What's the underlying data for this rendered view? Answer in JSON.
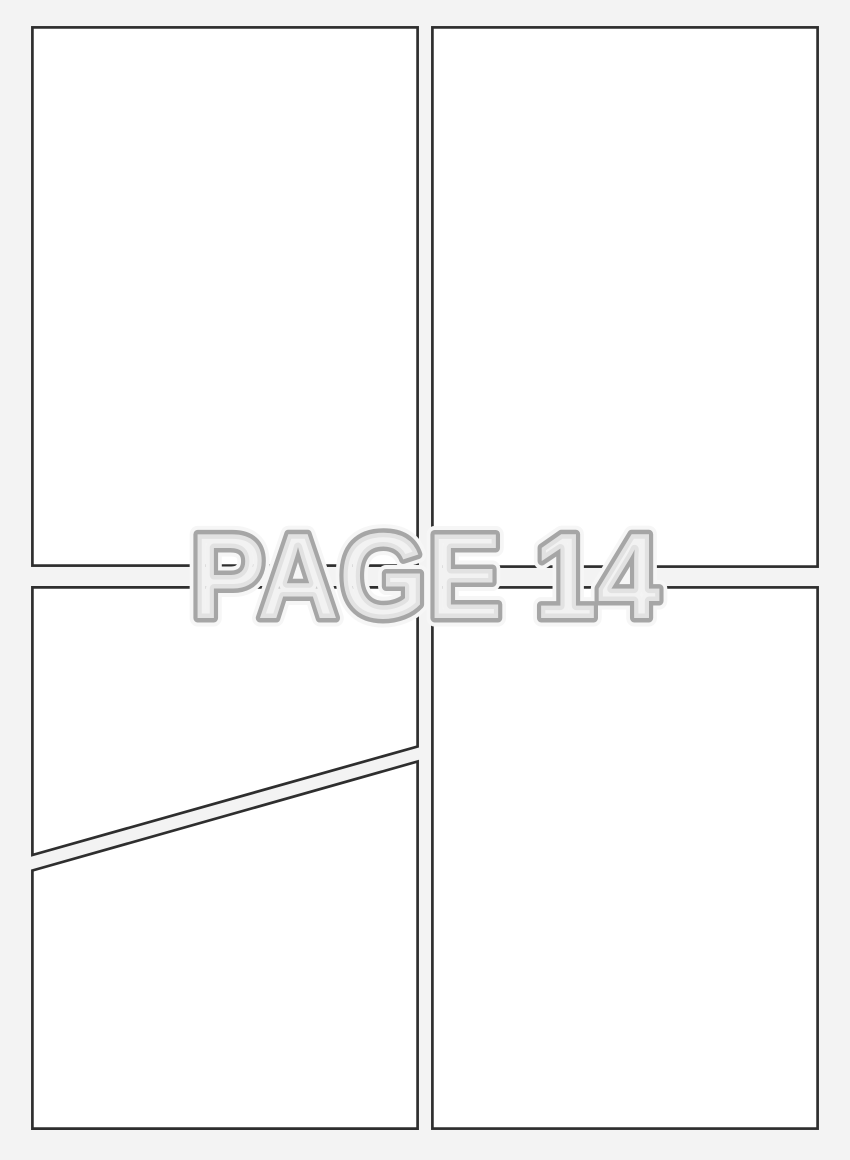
{
  "watermark": {
    "text": "PAGE 14"
  },
  "panels": [
    {
      "id": "panel-top-left"
    },
    {
      "id": "panel-top-right"
    },
    {
      "id": "panel-bottom-left-upper"
    },
    {
      "id": "panel-bottom-left-lower"
    },
    {
      "id": "panel-bottom-right"
    }
  ],
  "colors": {
    "background": "#f3f3f3",
    "panel_fill": "#ffffff",
    "panel_border": "#2e2e2e",
    "watermark_fill": "#f1f1f1",
    "watermark_stroke": "#a6a6a6",
    "watermark_halo": "#f6f6f6"
  }
}
